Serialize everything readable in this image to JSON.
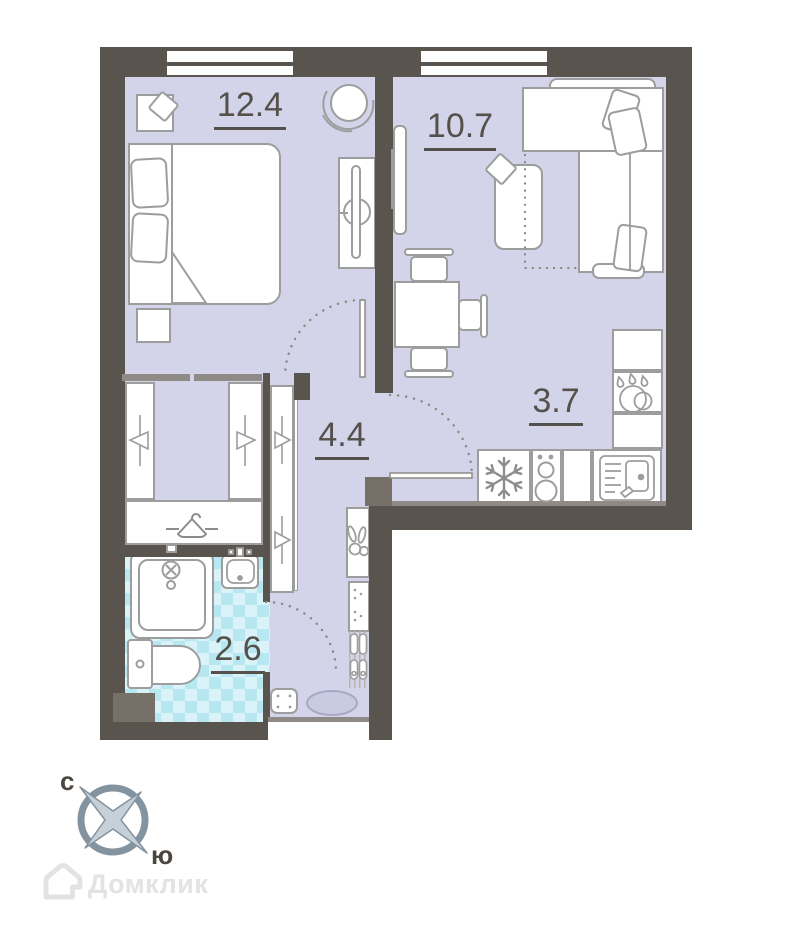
{
  "plan": {
    "title": "apartment-floor-plan",
    "rooms": [
      {
        "name": "bedroom",
        "area": "12.4"
      },
      {
        "name": "living-room",
        "area": "10.7"
      },
      {
        "name": "hallway",
        "area": "4.4"
      },
      {
        "name": "kitchen",
        "area": "3.7"
      },
      {
        "name": "bathroom",
        "area": "2.6"
      }
    ],
    "compass": {
      "north_label": "с",
      "south_label": "ю"
    },
    "watermark": {
      "brand": "Домклик"
    },
    "colors": {
      "wall": "#5a544e",
      "wall_light": "#767069",
      "floor": "#d3d4e9",
      "tile_base": "#d9f3f8",
      "tile_diamond": "#b7e7f1",
      "furniture_stroke": "#9d9d9d",
      "label": "#55504a",
      "compass_gray": "#8493a0",
      "watermark_gray": "#e4e3e1"
    },
    "icons": [
      "snowflake-icon",
      "stove-burners-icon",
      "kitchen-sink-icon",
      "dishwasher-drops-icon",
      "hanger-icon",
      "hanger-rail-icon",
      "shower-icon",
      "toilet-icon",
      "bath-sink-icon",
      "keys-icon",
      "slippers-icon",
      "tv-icon",
      "door-swing-arc",
      "compass-icon",
      "house-logo-icon"
    ]
  }
}
